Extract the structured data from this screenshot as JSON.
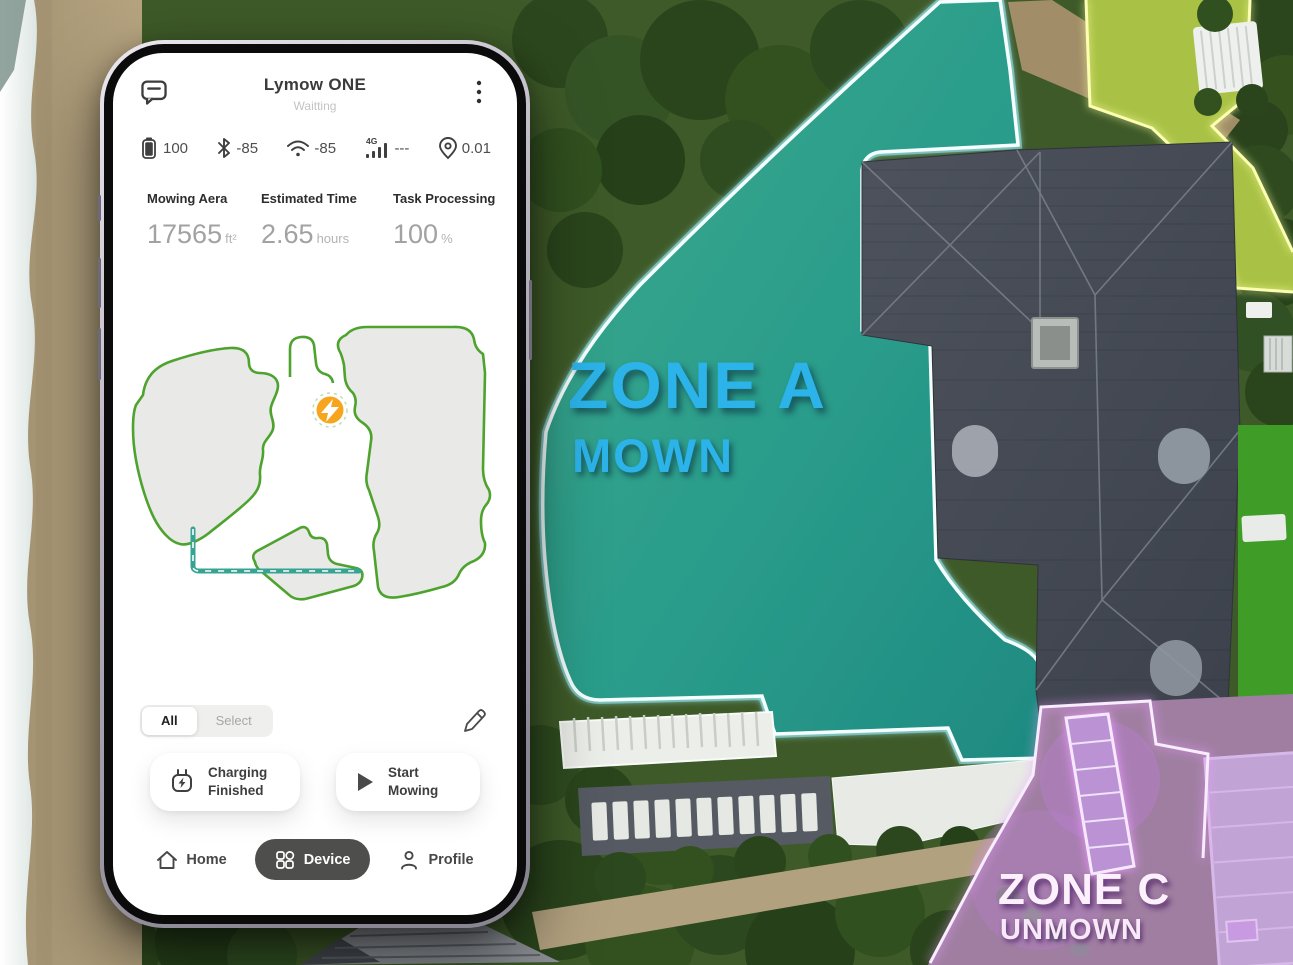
{
  "scene": {
    "zone_a": {
      "title": "ZONE A",
      "status": "MOWN",
      "color": "#2CB3E9"
    },
    "zone_c": {
      "title": "ZONE C",
      "status": "UNMOWN",
      "color": "#FDF0FD"
    }
  },
  "phone": {
    "header": {
      "title": "Lymow ONE",
      "status": "Waitting"
    },
    "status_bar": {
      "battery": "100",
      "bluetooth": "-85",
      "wifi": "-85",
      "network_type": "4G",
      "network_value": "---",
      "gps": "0.01"
    },
    "stats": [
      {
        "label": "Mowing Aera",
        "value": "17565",
        "unit": "ft²"
      },
      {
        "label": "Estimated Time",
        "value": "2.65",
        "unit": "hours"
      },
      {
        "label": "Task Processing",
        "value": "100",
        "unit": "%"
      }
    ],
    "map_tabs": {
      "all": "All",
      "select": "Select"
    },
    "actions": {
      "charging": "Charging Finished",
      "start": "Start Mowing"
    },
    "nav": {
      "home": "Home",
      "device": "Device",
      "profile": "Profile"
    },
    "colors": {
      "accent_orange": "#F7A41F",
      "map_outline_green": "#4DA32E",
      "path_teal": "#37A493",
      "nav_pill": "#4E4E4C"
    }
  }
}
